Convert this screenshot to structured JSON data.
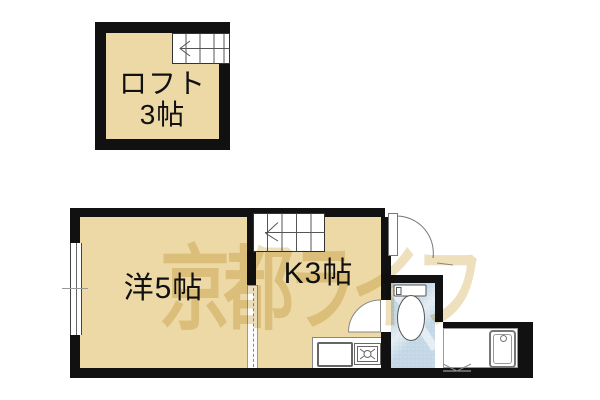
{
  "watermark": {
    "text": "京都ライフ"
  },
  "rooms": {
    "loft": {
      "name": "ロフト",
      "size": "3帖"
    },
    "western": {
      "label": "洋5帖"
    },
    "kitchen": {
      "label": "K3帖"
    }
  },
  "icons": {
    "loft_stairs": "staircase-up-left",
    "kitchen_stairs": "staircase-up-left",
    "entrance_door": "swing-door",
    "toilet_door": "swing-door",
    "bath_door": "folding-door",
    "window": "sliding-window",
    "divider": "sliding-partition",
    "toilet": "toilet-top-view",
    "bathtub": "bathtub-top-view",
    "sink": "kitchen-sink",
    "stove": "single-burner-stove"
  },
  "colors": {
    "wall": "#111111",
    "floor-tan": "#ecd9a6",
    "floor-blue": "#c3d7e6",
    "watermark": "#eee0bd",
    "line": "#777777"
  }
}
